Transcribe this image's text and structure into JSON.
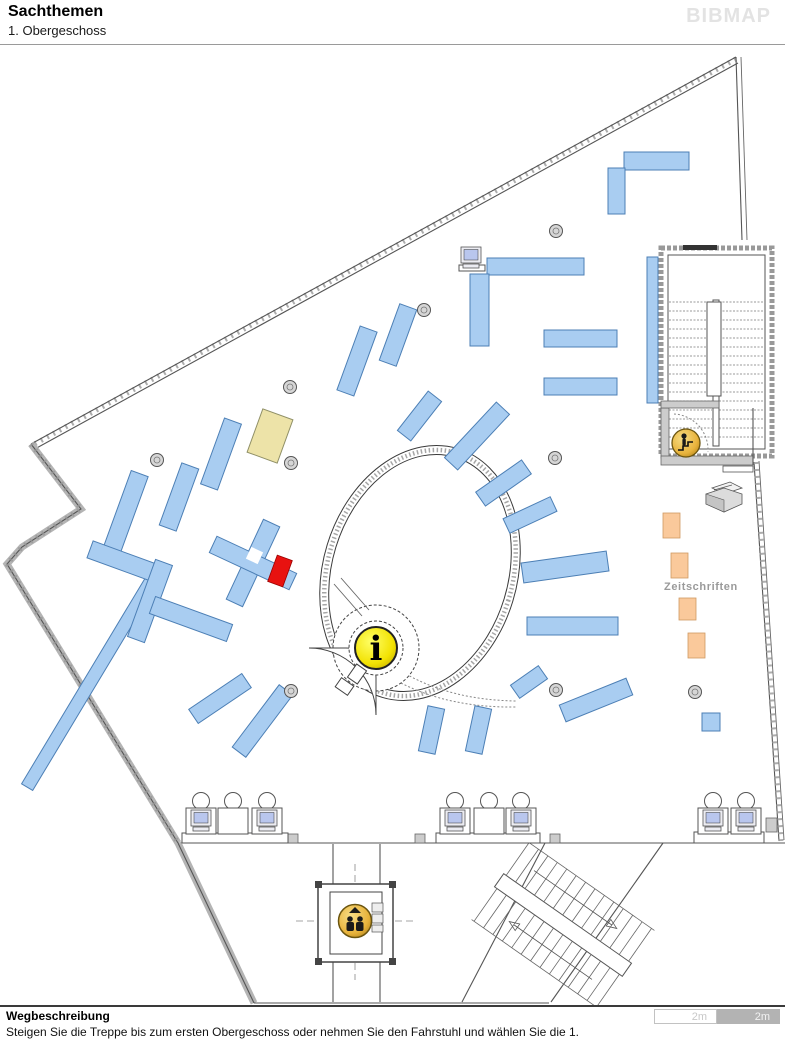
{
  "header": {
    "title": "Sachthemen",
    "subtitle": "1. Obergeschoss",
    "logo": "BIBMAP"
  },
  "map": {
    "zeitschriften_label": "Zeitschriften",
    "info_glyph": "i",
    "colors": {
      "shelf_blue": "#A9CDF1",
      "shelf_blue_border": "#4C7FB5",
      "shelf_red": "#E81210",
      "shelf_beige": "#EDE3A8",
      "shelf_orange": "#FAC99B",
      "icon_yellow": "#F2E203",
      "icon_gold": "#E8B33C",
      "wall_gray": "#555555",
      "label_gray": "#9A9A9A"
    },
    "shelves": {
      "blue": [
        [
          624,
          152,
          65,
          18,
          0
        ],
        [
          608,
          168,
          17,
          46,
          0
        ],
        [
          487,
          258,
          97,
          17,
          0
        ],
        [
          470,
          274,
          19,
          72,
          0
        ],
        [
          544,
          330,
          73,
          17,
          0
        ],
        [
          544,
          378,
          73,
          17,
          0
        ],
        [
          647,
          257,
          11,
          146,
          0
        ],
        [
          348,
          327,
          18,
          68,
          20
        ],
        [
          389,
          305,
          18,
          60,
          20
        ],
        [
          411,
          391,
          17,
          50,
          38
        ],
        [
          468,
          398,
          18,
          76,
          43
        ],
        [
          495,
          455,
          17,
          56,
          55
        ],
        [
          522,
          489,
          16,
          52,
          65
        ],
        [
          522,
          557,
          86,
          20,
          -8
        ],
        [
          527,
          617,
          91,
          18,
          0
        ],
        [
          512,
          674,
          34,
          16,
          -35
        ],
        [
          560,
          691,
          72,
          18,
          -22
        ],
        [
          423,
          707,
          17,
          46,
          12
        ],
        [
          470,
          707,
          17,
          46,
          12
        ],
        [
          702,
          713,
          18,
          18,
          0
        ],
        [
          85,
          555,
          13,
          250,
          31
        ],
        [
          212,
          419,
          18,
          70,
          20
        ],
        [
          170,
          464,
          18,
          66,
          20
        ],
        [
          116,
          471,
          18,
          86,
          20
        ],
        [
          88,
          552,
          68,
          18,
          20
        ],
        [
          141,
          560,
          18,
          82,
          20
        ],
        [
          150,
          610,
          82,
          18,
          20
        ],
        [
          188,
          690,
          64,
          17,
          -34
        ],
        [
          254,
          682,
          17,
          78,
          37
        ],
        [
          244,
          519,
          18,
          88,
          25
        ],
        [
          209,
          554,
          88,
          18,
          25
        ]
      ],
      "beige": [
        [
          254,
          413,
          32,
          46,
          20
        ]
      ],
      "orange": [
        [
          663,
          513,
          17,
          25,
          0
        ],
        [
          671,
          553,
          17,
          25,
          0
        ],
        [
          679,
          598,
          17,
          22,
          0
        ],
        [
          688,
          633,
          17,
          25,
          0
        ]
      ],
      "red": [
        [
          272,
          557,
          16,
          28,
          20
        ]
      ]
    },
    "columns": [
      [
        290,
        387
      ],
      [
        424,
        310
      ],
      [
        556,
        231
      ],
      [
        157,
        460
      ],
      [
        291,
        463
      ],
      [
        555,
        458
      ],
      [
        291,
        691
      ],
      [
        556,
        690
      ],
      [
        695,
        692
      ]
    ],
    "stations": [
      {
        "platform": [
          182,
          833,
          106,
          10
        ],
        "units": [
          {
            "x": 186,
            "t": "pc"
          },
          {
            "x": 218,
            "t": "desk"
          },
          {
            "x": 252,
            "t": "pc"
          }
        ]
      },
      {
        "platform": [
          436,
          833,
          104,
          10
        ],
        "units": [
          {
            "x": 440,
            "t": "pc"
          },
          {
            "x": 474,
            "t": "desk"
          },
          {
            "x": 506,
            "t": "pc"
          }
        ]
      },
      {
        "platform": [
          694,
          832,
          70,
          11
        ],
        "units": [
          {
            "x": 698,
            "t": "pc"
          },
          {
            "x": 731,
            "t": "pc"
          }
        ]
      }
    ],
    "top_pc": {
      "x": 461,
      "y": 247
    },
    "icons": [
      {
        "name": "info-icon",
        "x": 376,
        "y": 648
      },
      {
        "name": "elevator-icon",
        "x": 355,
        "y": 921
      },
      {
        "name": "stairs-person-icon",
        "x": 686,
        "y": 443
      }
    ]
  },
  "footer": {
    "heading": "Wegbeschreibung",
    "description": "Steigen Sie die Treppe bis zum ersten Obergeschoss oder nehmen Sie den Fahrstuhl und wählen Sie die 1.",
    "scale_segments": [
      {
        "label": "2m",
        "variant": "light"
      },
      {
        "label": "2m",
        "variant": "dark"
      }
    ]
  }
}
